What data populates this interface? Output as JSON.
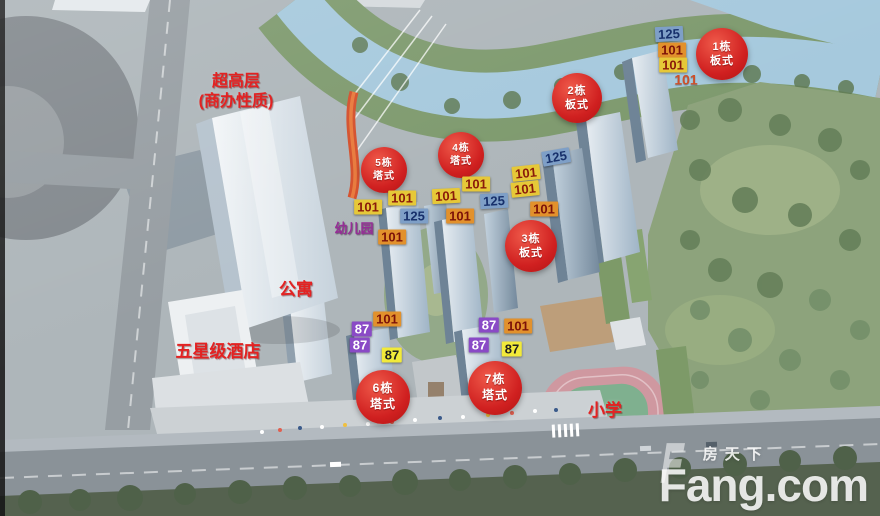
{
  "watermark": {
    "site_name": "房天下",
    "site_domain": "Fang.com"
  },
  "palette": {
    "badge_red": "#cf1f1f",
    "label_red": "#e32222",
    "label_purple": "#962d96",
    "tag_styles": {
      "blue": {
        "bg": "#7e9fc7",
        "fg": "#17306b"
      },
      "orange": {
        "bg": "#e2912c",
        "fg": "#7c1208"
      },
      "yellow": {
        "bg": "#e6c838",
        "fg": "#8a1a0a"
      },
      "yellow_bright": {
        "bg": "#f2ea3a",
        "fg": "#1f1f1f"
      },
      "purple": {
        "bg": "#8a4ac6",
        "fg": "#ffffff"
      },
      "plain": {
        "bg": "transparent",
        "fg": "#cf4f28"
      }
    }
  },
  "building_circles": [
    {
      "id": "1",
      "building": "1栋",
      "type": "板式",
      "x": 722,
      "y": 54,
      "r": 26
    },
    {
      "id": "2",
      "building": "2栋",
      "type": "板式",
      "x": 577,
      "y": 98,
      "r": 25
    },
    {
      "id": "3",
      "building": "3栋",
      "type": "板式",
      "x": 531,
      "y": 246,
      "r": 26
    },
    {
      "id": "4",
      "building": "4栋",
      "type": "塔式",
      "x": 461,
      "y": 155,
      "r": 23
    },
    {
      "id": "5",
      "building": "5栋",
      "type": "塔式",
      "x": 384,
      "y": 170,
      "r": 23
    },
    {
      "id": "6",
      "building": "6栋",
      "type": "塔式",
      "x": 383,
      "y": 397,
      "r": 27
    },
    {
      "id": "7",
      "building": "7栋",
      "type": "塔式",
      "x": 495,
      "y": 388,
      "r": 27
    }
  ],
  "unit_tags": [
    {
      "value": "125",
      "style": "blue",
      "x": 669,
      "y": 34,
      "rot": -3
    },
    {
      "value": "101",
      "style": "orange",
      "x": 672,
      "y": 50,
      "rot": 0
    },
    {
      "value": "101",
      "style": "yellow",
      "x": 673,
      "y": 65,
      "rot": 0
    },
    {
      "value": "101",
      "style": "plain",
      "x": 686,
      "y": 80,
      "rot": 0
    },
    {
      "value": "125",
      "style": "blue",
      "x": 556,
      "y": 157,
      "rot": -10
    },
    {
      "value": "101",
      "style": "yellow",
      "x": 526,
      "y": 173,
      "rot": -6
    },
    {
      "value": "101",
      "style": "yellow",
      "x": 525,
      "y": 189,
      "rot": -6
    },
    {
      "value": "101",
      "style": "orange",
      "x": 544,
      "y": 209,
      "rot": 0
    },
    {
      "value": "125",
      "style": "blue",
      "x": 494,
      "y": 201,
      "rot": -3
    },
    {
      "value": "101",
      "style": "yellow",
      "x": 476,
      "y": 184,
      "rot": 0
    },
    {
      "value": "101",
      "style": "yellow",
      "x": 446,
      "y": 196,
      "rot": -3
    },
    {
      "value": "101",
      "style": "orange",
      "x": 460,
      "y": 216,
      "rot": 0
    },
    {
      "value": "101",
      "style": "yellow",
      "x": 402,
      "y": 198,
      "rot": 0
    },
    {
      "value": "125",
      "style": "blue",
      "x": 414,
      "y": 216,
      "rot": 0
    },
    {
      "value": "101",
      "style": "yellow",
      "x": 368,
      "y": 207,
      "rot": 0
    },
    {
      "value": "101",
      "style": "orange",
      "x": 392,
      "y": 237,
      "rot": 0
    },
    {
      "value": "101",
      "style": "orange",
      "x": 387,
      "y": 319,
      "rot": 0
    },
    {
      "value": "87",
      "style": "purple",
      "x": 362,
      "y": 329,
      "rot": 0
    },
    {
      "value": "87",
      "style": "purple",
      "x": 360,
      "y": 345,
      "rot": 0
    },
    {
      "value": "87",
      "style": "yellow_bright",
      "x": 392,
      "y": 355,
      "rot": 0
    },
    {
      "value": "87",
      "style": "purple",
      "x": 489,
      "y": 325,
      "rot": 0
    },
    {
      "value": "101",
      "style": "orange",
      "x": 518,
      "y": 326,
      "rot": 0
    },
    {
      "value": "87",
      "style": "purple",
      "x": 479,
      "y": 345,
      "rot": 0
    },
    {
      "value": "87",
      "style": "yellow_bright",
      "x": 512,
      "y": 349,
      "rot": 0
    }
  ],
  "area_labels": [
    {
      "id": "super-highrise",
      "lines": [
        "超高层",
        "(商办性质)"
      ],
      "x": 236,
      "y": 72,
      "size": 16,
      "color": "red"
    },
    {
      "id": "apartment",
      "lines": [
        "公寓"
      ],
      "x": 296,
      "y": 280,
      "size": 17,
      "color": "red"
    },
    {
      "id": "five-star-hotel",
      "lines": [
        "五星级酒店"
      ],
      "x": 218,
      "y": 342,
      "size": 17,
      "color": "red"
    },
    {
      "id": "kindergarten",
      "lines": [
        "幼儿园"
      ],
      "x": 354,
      "y": 221,
      "size": 13,
      "color": "purple"
    },
    {
      "id": "primary-school",
      "lines": [
        "小学"
      ],
      "x": 605,
      "y": 401,
      "size": 17,
      "color": "red"
    }
  ]
}
